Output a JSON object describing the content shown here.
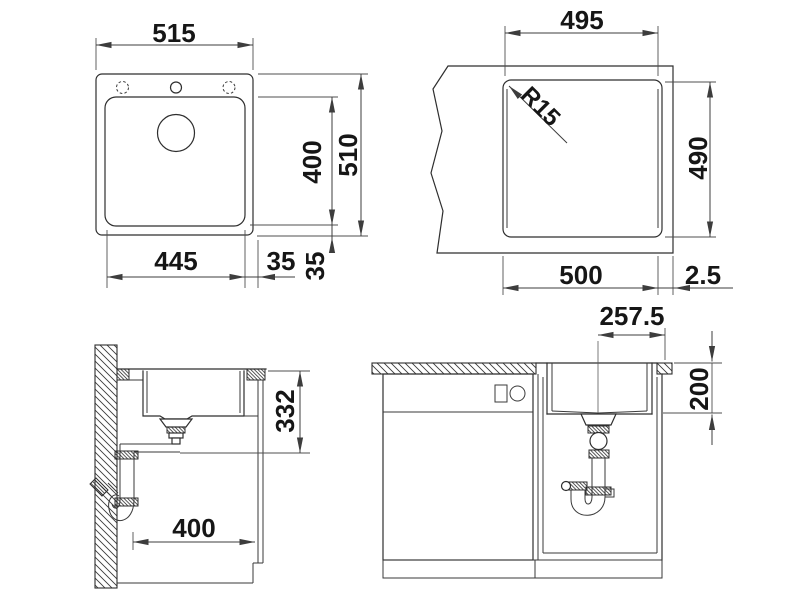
{
  "drawing_type": "kitchen-sink-installation-drawing",
  "colors": {
    "background": "#ffffff",
    "line": "#2e2e2e",
    "dimension_text": "#161616"
  },
  "views": {
    "plan": {
      "description": "top view of sink",
      "dims": {
        "overall_width": "515",
        "bowl_depth": "400",
        "overall_depth": "510",
        "bowl_width": "445",
        "rim_side": "35",
        "rim_back": "35"
      }
    },
    "cutout": {
      "description": "worktop cut-out",
      "dims": {
        "width_top": "495",
        "corner_radius": "R15",
        "depth": "490",
        "width_bottom": "500",
        "edge_gap": "2.5"
      }
    },
    "side": {
      "description": "side section with siphon",
      "dims": {
        "install_depth": "332",
        "cabinet_clearance": "400"
      }
    },
    "front": {
      "description": "front section in base cabinet",
      "dims": {
        "drain_center_offset": "257.5",
        "bowl_height": "200"
      }
    }
  }
}
